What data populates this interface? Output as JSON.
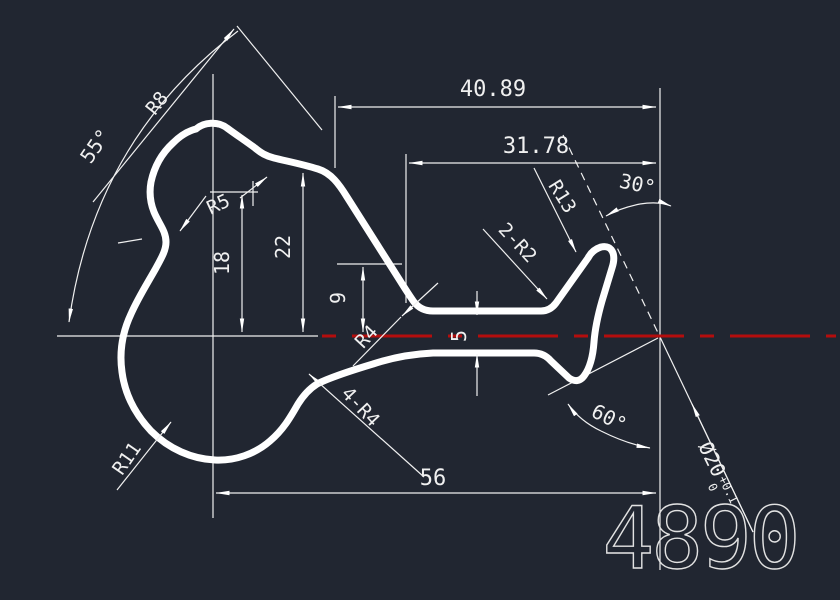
{
  "canvas": {
    "background_color": "#212631",
    "line_color": "#ffffff",
    "centerline_color": "#b40d0d",
    "part_number_color": "#e2e2e2"
  },
  "dims": {
    "w4089": "40.89",
    "w3178": "31.78",
    "w56": "56",
    "h22": "22",
    "h18": "18",
    "h9": "9",
    "t5": "5"
  },
  "angles": {
    "a55": "55°",
    "a30": "30°",
    "a60": "60°"
  },
  "radii": {
    "r8": "R8",
    "r5": "R5",
    "r4": "R4",
    "r11": "R11",
    "r13": "R13"
  },
  "fillets": {
    "f2r2": "2-R2",
    "f4r4": "4-R4"
  },
  "diameter": {
    "value": "Ø20",
    "tol_upper": "+0.1",
    "tol_lower": "0"
  },
  "part_number": "4890"
}
